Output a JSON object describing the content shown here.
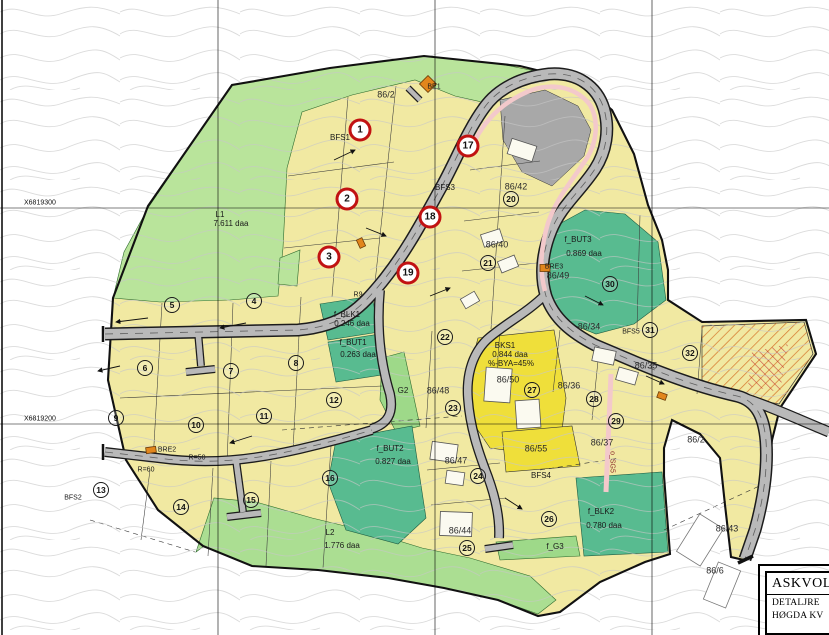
{
  "plan": {
    "title_block": {
      "name": "ASKVOL",
      "line1": "DETALJRE",
      "line2": "HØGDA KV"
    },
    "grid_labels": {
      "north1": "X6819300",
      "north2": "X6819200"
    },
    "markers": {
      "red": [
        "1",
        "2",
        "3",
        "17",
        "18",
        "19"
      ],
      "plain": [
        "4",
        "5",
        "6",
        "7",
        "8",
        "9",
        "10",
        "11",
        "12",
        "13",
        "14",
        "15",
        "16",
        "20",
        "21",
        "22",
        "23",
        "24",
        "25",
        "26",
        "27",
        "28",
        "29",
        "30",
        "31",
        "32"
      ]
    },
    "labels": {
      "gnr86_2_top": "86/2",
      "be1": "BE1",
      "bfs1": "BFS1",
      "bfs3": "BFS3",
      "gnr86_42": "86/42",
      "l1": "L1",
      "l1_area": "7.611 daa",
      "gnr86_40": "86/40",
      "f_but3": "f_BUT3",
      "f_but3_area": "0.869 daa",
      "bre3": "BRE3",
      "gnr86_49": "86/49",
      "f_blk1": "f_BLK1",
      "f_blk1_area": "0.246 daa",
      "f_but1": "f_BUT1",
      "f_but1_area": "0.263 daa",
      "gnr86_34": "86/34",
      "bfs5": "BFS5",
      "gnr86_35": "86/35",
      "gnr86_36": "86/36",
      "bks1": "BKS1",
      "bks1_area": "0.844 daa",
      "bks1_bya": "%-BYA=45%",
      "gnr86_50": "86/50",
      "g2": "G2",
      "gnr86_48": "86/48",
      "f_but2": "f_BUT2",
      "f_but2_area": "0.827 daa",
      "gnr86_47": "86/47",
      "gnr86_44": "86/44",
      "gnr86_55": "86/55",
      "bfs4": "BFS4",
      "gnr86_37": "86/37",
      "f_blk2": "f_BLK2",
      "f_blk2_area": "0.780 daa",
      "f_g3": "f_G3",
      "l2": "L2",
      "l2_area": "1.776 daa",
      "bfs2": "BFS2",
      "bre2": "BRE2",
      "gnr86_43": "86/43",
      "gnr86_6": "86/6",
      "gnr86_2_right": "86/2",
      "r50": "R=50",
      "r60": "R=60",
      "r9": "R9",
      "o_sg5": "o_SG5"
    },
    "colors": {
      "area_yellow": "#f1e9a2",
      "area_green_light": "#b9e49b",
      "area_green_teal": "#58bb90",
      "area_yellow_bright": "#efdf3a",
      "area_grey": "#a8a8a8",
      "road_grey": "#b9b9b9",
      "sidewalk_pink": "#f3c9cb",
      "marker_red": "#c11212",
      "marker_orange": "#e2861c"
    }
  }
}
